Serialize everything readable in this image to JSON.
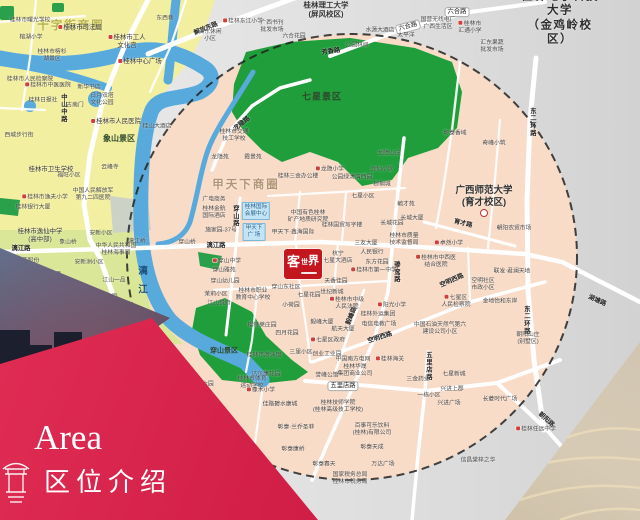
{
  "banner": {
    "area_en": "Area",
    "area_cn": "区位介绍"
  },
  "logo": {
    "c1": "客",
    "c2": "世",
    "c3": "界",
    "name": "客世界"
  },
  "colors": {
    "circle_fill": "#f8dcc8",
    "outside_gray": "#dadada",
    "yellow_zone": "#f3efa0",
    "green_zone": "#dbe798",
    "park_green": "#1f9e3b",
    "river_blue": "#58aadc",
    "banner_red": "#d21f47",
    "logo_red": "#c4161e",
    "dash_line": "#222222"
  },
  "map": {
    "labels": [
      {
        "t": "十字街商圈",
        "x": 71,
        "y": 26,
        "c": "z1"
      },
      {
        "t": "甲天下商圈",
        "x": 246,
        "y": 185,
        "c": "z2"
      },
      {
        "t": "联达商圈",
        "x": 40,
        "y": 278,
        "c": "z3"
      },
      {
        "t": "七星景区",
        "x": 322,
        "y": 97,
        "c": "p1"
      },
      {
        "t": "象山景区",
        "x": 119,
        "y": 139,
        "c": "p2"
      },
      {
        "t": "穿山景区",
        "x": 224,
        "y": 352,
        "c": "p3"
      },
      {
        "t": "桂林电子科技大学\n（金鸡岭校区）",
        "x": 560,
        "y": 18,
        "c": "u1"
      },
      {
        "t": "广西师范大学\n(育才校区)",
        "x": 484,
        "y": 197,
        "c": "u2"
      },
      {
        "t": "",
        "x": 484,
        "y": 213,
        "c": "ring"
      },
      {
        "t": "桂林理工大学\n(屏风校区)",
        "x": 326,
        "y": 10,
        "c": "u3"
      },
      {
        "t": "漓江",
        "x": 141,
        "y": 284,
        "c": "riv"
      },
      {
        "t": "解放东路",
        "x": 206,
        "y": 29,
        "c": "rd",
        "r": -22
      },
      {
        "t": "东西巷",
        "x": 165,
        "y": 19,
        "c": "xs"
      },
      {
        "t": "六合路",
        "x": 408,
        "y": 27,
        "c": "rdp",
        "r": -15
      },
      {
        "t": "六合路",
        "x": 457,
        "y": 12,
        "c": "rdp"
      },
      {
        "t": "龙隐路",
        "x": 242,
        "y": 124,
        "c": "rd",
        "r": -38
      },
      {
        "t": "漓江路",
        "x": 21,
        "y": 249,
        "c": "rd"
      },
      {
        "t": "漓江路",
        "x": 216,
        "y": 246,
        "c": "rd"
      },
      {
        "t": "中山中路",
        "x": 63,
        "y": 108,
        "c": "rdv"
      },
      {
        "t": "穿山路",
        "x": 235,
        "y": 216,
        "c": "rdv"
      },
      {
        "t": "骖鸾路",
        "x": 396,
        "y": 272,
        "c": "rdv"
      },
      {
        "t": "毅峰路",
        "x": 352,
        "y": 316,
        "c": "rd",
        "r": -68
      },
      {
        "t": "东二环路",
        "x": 532,
        "y": 122,
        "c": "rdv"
      },
      {
        "t": "东二环路",
        "x": 526,
        "y": 320,
        "c": "rdv"
      },
      {
        "t": "育才路",
        "x": 463,
        "y": 224,
        "c": "rd",
        "r": 14
      },
      {
        "t": "五里店路",
        "x": 343,
        "y": 386,
        "c": "rdp"
      },
      {
        "t": "五里店路",
        "x": 428,
        "y": 366,
        "c": "rdv"
      },
      {
        "t": "空明西路",
        "x": 380,
        "y": 338,
        "c": "rd",
        "r": -18
      },
      {
        "t": "空明西路",
        "x": 452,
        "y": 281,
        "c": "rd",
        "r": -24
      },
      {
        "t": "朝阳路",
        "x": 546,
        "y": 420,
        "c": "rd",
        "r": 42
      },
      {
        "t": "湖塘路",
        "x": 597,
        "y": 301,
        "c": "rd",
        "r": 24
      },
      {
        "t": "芳香路",
        "x": 331,
        "y": 52,
        "c": "rd",
        "r": -8
      },
      {
        "t": "桂林市司法局",
        "x": 80,
        "y": 28,
        "i": 1
      },
      {
        "t": "桂林市曙光学校",
        "x": 30,
        "y": 21,
        "c": "xs"
      },
      {
        "t": "榕湖小学",
        "x": 31,
        "y": 38,
        "c": "xs"
      },
      {
        "t": "桂林市工人\n文化宫",
        "x": 127,
        "y": 42,
        "i": 1
      },
      {
        "t": "桂林中心广场",
        "x": 140,
        "y": 62,
        "i": 1
      },
      {
        "t": "桂林市榕杉\n湖景区",
        "x": 52,
        "y": 56,
        "c": "xs"
      },
      {
        "t": "桂林市人民检察院",
        "x": 30,
        "y": 80,
        "c": "xs"
      },
      {
        "t": "桂林市中医医院",
        "x": 48,
        "y": 86,
        "c": "xs",
        "i": 1
      },
      {
        "t": "新华书店",
        "x": 89,
        "y": 88,
        "c": "xs"
      },
      {
        "t": "西城步行街",
        "x": 19,
        "y": 136,
        "c": "xs"
      },
      {
        "t": "桂林日报社",
        "x": 43,
        "y": 101,
        "c": "xs"
      },
      {
        "t": "古南门",
        "x": 75,
        "y": 106,
        "c": "xs"
      },
      {
        "t": "日月双塔\n文化公园",
        "x": 102,
        "y": 100,
        "c": "xs"
      },
      {
        "t": "桂林市人民医院",
        "x": 116,
        "y": 122,
        "i": 1
      },
      {
        "t": "桂山大酒店",
        "x": 157,
        "y": 127,
        "c": "xs"
      },
      {
        "t": "云峰寺",
        "x": 110,
        "y": 168,
        "c": "xs"
      },
      {
        "t": "福旺小区",
        "x": 69,
        "y": 176,
        "c": "xs"
      },
      {
        "t": "桂林市卫生学校",
        "x": 51,
        "y": 170
      },
      {
        "t": "中国人民解放军\n第九二四医院",
        "x": 93,
        "y": 195,
        "c": "xs"
      },
      {
        "t": "桂林市逸夫小学",
        "x": 45,
        "y": 198,
        "c": "xs",
        "i": 1
      },
      {
        "t": "桂林银行大厦",
        "x": 33,
        "y": 208,
        "c": "xs"
      },
      {
        "t": "桂林市逸仙中学\n(高中部)",
        "x": 40,
        "y": 236
      },
      {
        "t": "桂林三花股份\n有限公司",
        "x": 22,
        "y": 265,
        "c": "xs"
      },
      {
        "t": "象山桥",
        "x": 68,
        "y": 243,
        "c": "xs"
      },
      {
        "t": "漓江桥",
        "x": 137,
        "y": 242,
        "c": "xs"
      },
      {
        "t": "穿山桥",
        "x": 187,
        "y": 243,
        "c": "xs"
      },
      {
        "t": "安新小区",
        "x": 101,
        "y": 234,
        "c": "xs"
      },
      {
        "t": "中华人民共和国\n桂林海事局",
        "x": 116,
        "y": 250,
        "c": "xs"
      },
      {
        "t": "安新洲小区",
        "x": 89,
        "y": 263,
        "c": "xs"
      },
      {
        "t": "江山一品",
        "x": 114,
        "y": 281,
        "c": "xs"
      },
      {
        "t": "江畔丽园",
        "x": 106,
        "y": 298,
        "c": "xs"
      },
      {
        "t": "安新小区-南区",
        "x": 84,
        "y": 310,
        "c": "xs"
      },
      {
        "t": "漓东休闲\n小区",
        "x": 210,
        "y": 36,
        "c": "xs"
      },
      {
        "t": "桂林东江小学",
        "x": 243,
        "y": 22,
        "c": "xs",
        "i": 1
      },
      {
        "t": "广西书刊\n批发市场",
        "x": 272,
        "y": 27,
        "c": "xs"
      },
      {
        "t": "六合花园",
        "x": 294,
        "y": 37,
        "c": "xs"
      },
      {
        "t": "水源大酒店",
        "x": 380,
        "y": 31,
        "c": "xs"
      },
      {
        "t": "太平洋",
        "x": 406,
        "y": 36,
        "c": "xs"
      },
      {
        "t": "公园林间",
        "x": 357,
        "y": 46,
        "c": "xs"
      },
      {
        "t": "国营无线电厂\n广西生活区",
        "x": 438,
        "y": 24,
        "c": "xs"
      },
      {
        "t": "桂林市\n汇通小学",
        "x": 470,
        "y": 28,
        "c": "xs",
        "i": 1
      },
      {
        "t": "汇东果蔬\n批发市场",
        "x": 492,
        "y": 47,
        "c": "xs"
      },
      {
        "t": "桂林市交通\n技工学校",
        "x": 234,
        "y": 136,
        "c": "xs"
      },
      {
        "t": "龙隐苑",
        "x": 220,
        "y": 158,
        "c": "xs"
      },
      {
        "t": "霞景苑",
        "x": 253,
        "y": 158,
        "c": "xs"
      },
      {
        "t": "龙隐小学",
        "x": 330,
        "y": 170,
        "c": "xs",
        "i": 1
      },
      {
        "t": "桂林三金办公楼",
        "x": 298,
        "y": 177,
        "c": "xs"
      },
      {
        "t": "公园绿涛湾西园",
        "x": 352,
        "y": 178,
        "c": "xs"
      },
      {
        "t": "七星小区",
        "x": 363,
        "y": 197,
        "c": "xs"
      },
      {
        "t": "龙隐山庄",
        "x": 389,
        "y": 154,
        "c": "xs"
      },
      {
        "t": "会仙小区",
        "x": 382,
        "y": 170,
        "c": "xs"
      },
      {
        "t": "棕榈城",
        "x": 382,
        "y": 185,
        "c": "xs"
      },
      {
        "t": "桂林国际\n会展中心",
        "x": 256,
        "y": 211,
        "c": "bb"
      },
      {
        "t": "甲天下\n广 场",
        "x": 254,
        "y": 232,
        "c": "bb"
      },
      {
        "t": "广电商务",
        "x": 214,
        "y": 200,
        "c": "xs"
      },
      {
        "t": "桂林金航\n国际酒店",
        "x": 214,
        "y": 213,
        "c": "xs"
      },
      {
        "t": "施家园-37号",
        "x": 221,
        "y": 231,
        "c": "xs"
      },
      {
        "t": "桂林国贸写字楼",
        "x": 342,
        "y": 226,
        "c": "xs"
      },
      {
        "t": "甲天下·鑫海国际",
        "x": 293,
        "y": 233,
        "c": "xs"
      },
      {
        "t": "中国有色桂林\n矿产地质研究院",
        "x": 308,
        "y": 217,
        "c": "xs"
      },
      {
        "t": "长城花园",
        "x": 392,
        "y": 224,
        "c": "xs"
      },
      {
        "t": "桂林市质量\n技术监督局",
        "x": 404,
        "y": 240,
        "c": "xs"
      },
      {
        "t": "毓才苑",
        "x": 406,
        "y": 205,
        "c": "xs"
      },
      {
        "t": "长城大厦",
        "x": 412,
        "y": 219,
        "c": "xs"
      },
      {
        "t": "杭宁\n七星大酒店",
        "x": 338,
        "y": 258,
        "c": "xs"
      },
      {
        "t": "三友大厦",
        "x": 366,
        "y": 244,
        "c": "xs"
      },
      {
        "t": "人民银行",
        "x": 372,
        "y": 253,
        "c": "xs"
      },
      {
        "t": "东方花园",
        "x": 377,
        "y": 263,
        "c": "xs"
      },
      {
        "t": "桂林市第一中学",
        "x": 374,
        "y": 271,
        "c": "xs",
        "i": 1
      },
      {
        "t": "天香佳园",
        "x": 336,
        "y": 282,
        "c": "xs"
      },
      {
        "t": "世纪新城",
        "x": 332,
        "y": 293,
        "c": "xs"
      },
      {
        "t": "桂林市中级\n人民法院",
        "x": 347,
        "y": 304,
        "c": "xs",
        "i": 1
      },
      {
        "t": "穿山中学",
        "x": 227,
        "y": 262,
        "c": "xs",
        "i": 1
      },
      {
        "t": "穿山雅苑",
        "x": 224,
        "y": 271,
        "c": "xs"
      },
      {
        "t": "穿山幼儿园",
        "x": 225,
        "y": 282,
        "c": "xs"
      },
      {
        "t": "茉莉小区",
        "x": 216,
        "y": 295,
        "c": "xs"
      },
      {
        "t": "江山悦府",
        "x": 219,
        "y": 304,
        "c": "xs"
      },
      {
        "t": "桂林市职业\n教育中心学校",
        "x": 253,
        "y": 295,
        "c": "xs"
      },
      {
        "t": "穿山东社区",
        "x": 286,
        "y": 288,
        "c": "xs"
      },
      {
        "t": "七星花园",
        "x": 309,
        "y": 296,
        "c": "xs"
      },
      {
        "t": "小荷园",
        "x": 291,
        "y": 306,
        "c": "xs"
      },
      {
        "t": "樱特莱庄园",
        "x": 262,
        "y": 326,
        "c": "xs"
      },
      {
        "t": "毅峰大厦",
        "x": 322,
        "y": 323,
        "c": "xs"
      },
      {
        "t": "航天大厦",
        "x": 343,
        "y": 330,
        "c": "xs"
      },
      {
        "t": "七星区政府",
        "x": 328,
        "y": 341,
        "c": "xs",
        "i": 1
      },
      {
        "t": "四月花园",
        "x": 287,
        "y": 334,
        "c": "xs"
      },
      {
        "t": "电信电教广场",
        "x": 379,
        "y": 325,
        "c": "xs"
      },
      {
        "t": "阳光小学",
        "x": 392,
        "y": 306,
        "c": "xs",
        "i": 1
      },
      {
        "t": "桂林外运集团",
        "x": 378,
        "y": 315,
        "c": "xs"
      },
      {
        "t": "彰泰香域",
        "x": 455,
        "y": 134,
        "c": "xs"
      },
      {
        "t": "奇峰小筑",
        "x": 494,
        "y": 144,
        "c": "xs"
      },
      {
        "t": "朝阳农贸市场",
        "x": 514,
        "y": 229,
        "c": "xs"
      },
      {
        "t": "卓然小学",
        "x": 449,
        "y": 244,
        "c": "xs",
        "i": 1
      },
      {
        "t": "桂林市中西医\n结合医院",
        "x": 436,
        "y": 262,
        "c": "xs",
        "i": 1
      },
      {
        "t": "联发·君澜天地",
        "x": 512,
        "y": 272,
        "c": "xs"
      },
      {
        "t": "空明社区\n市政小区",
        "x": 483,
        "y": 285,
        "c": "xs"
      },
      {
        "t": "七星区\n人民检察院",
        "x": 456,
        "y": 302,
        "c": "xs",
        "i": 1
      },
      {
        "t": "金地怡和东岸",
        "x": 500,
        "y": 302,
        "c": "xs"
      },
      {
        "t": "中国石油天然气第六\n建设公司小区",
        "x": 440,
        "y": 329,
        "c": "xs"
      },
      {
        "t": "朝阳山庄\n(别墅区)",
        "x": 528,
        "y": 339,
        "c": "xs"
      },
      {
        "t": "桂林任远中学",
        "x": 536,
        "y": 430,
        "c": "xs",
        "i": 1
      },
      {
        "t": "信昌棠梓之华",
        "x": 478,
        "y": 461,
        "c": "xs"
      },
      {
        "t": "长菱时代广场",
        "x": 500,
        "y": 400,
        "c": "xs"
      },
      {
        "t": "七星新城",
        "x": 454,
        "y": 375,
        "c": "xs"
      },
      {
        "t": "兴进上郡",
        "x": 452,
        "y": 390,
        "c": "xs"
      },
      {
        "t": "兴进广场",
        "x": 449,
        "y": 404,
        "c": "xs"
      },
      {
        "t": "一栋小区",
        "x": 429,
        "y": 396,
        "c": "xs"
      },
      {
        "t": "三金药业",
        "x": 418,
        "y": 380,
        "c": "xs"
      },
      {
        "t": "桂林市游泳馆",
        "x": 264,
        "y": 356,
        "c": "xs"
      },
      {
        "t": "三里小区",
        "x": 301,
        "y": 353,
        "c": "xs"
      },
      {
        "t": "创业工业园",
        "x": 327,
        "y": 355,
        "c": "xs"
      },
      {
        "t": "中国南方电网",
        "x": 353,
        "y": 360,
        "c": "xs"
      },
      {
        "t": "桂林海关",
        "x": 390,
        "y": 360,
        "c": "xs",
        "i": 1
      },
      {
        "t": "桂林华晟\n集团商业公司",
        "x": 355,
        "y": 371,
        "c": "xs"
      },
      {
        "t": "誉峰公馆",
        "x": 327,
        "y": 376,
        "c": "xs"
      },
      {
        "t": "达尔康花园",
        "x": 266,
        "y": 375,
        "c": "xs"
      },
      {
        "t": "桂林市体育\n运动学校",
        "x": 252,
        "y": 383,
        "c": "xs"
      },
      {
        "t": "橡木小学",
        "x": 261,
        "y": 391,
        "c": "xs",
        "i": 1
      },
      {
        "t": "第六园",
        "x": 205,
        "y": 385,
        "c": "xs"
      },
      {
        "t": "佳路碧水康城",
        "x": 280,
        "y": 405,
        "c": "xs"
      },
      {
        "t": "桂林技师学院\n(桂林高级技工学校)",
        "x": 338,
        "y": 407,
        "c": "xs"
      },
      {
        "t": "彰泰·兰乔圣菲",
        "x": 296,
        "y": 428,
        "c": "xs"
      },
      {
        "t": "百事可乐饮料\n(桂林)有限公司",
        "x": 372,
        "y": 430,
        "c": "xs"
      },
      {
        "t": "彰泰康桥",
        "x": 293,
        "y": 450,
        "c": "xs"
      },
      {
        "t": "彰泰天成",
        "x": 372,
        "y": 448,
        "c": "xs"
      },
      {
        "t": "万达广场",
        "x": 383,
        "y": 465,
        "c": "xs"
      },
      {
        "t": "彰泰春天",
        "x": 324,
        "y": 465,
        "c": "xs"
      },
      {
        "t": "国家税务总局\n桂林市税务局",
        "x": 350,
        "y": 479,
        "c": "xs"
      }
    ]
  }
}
